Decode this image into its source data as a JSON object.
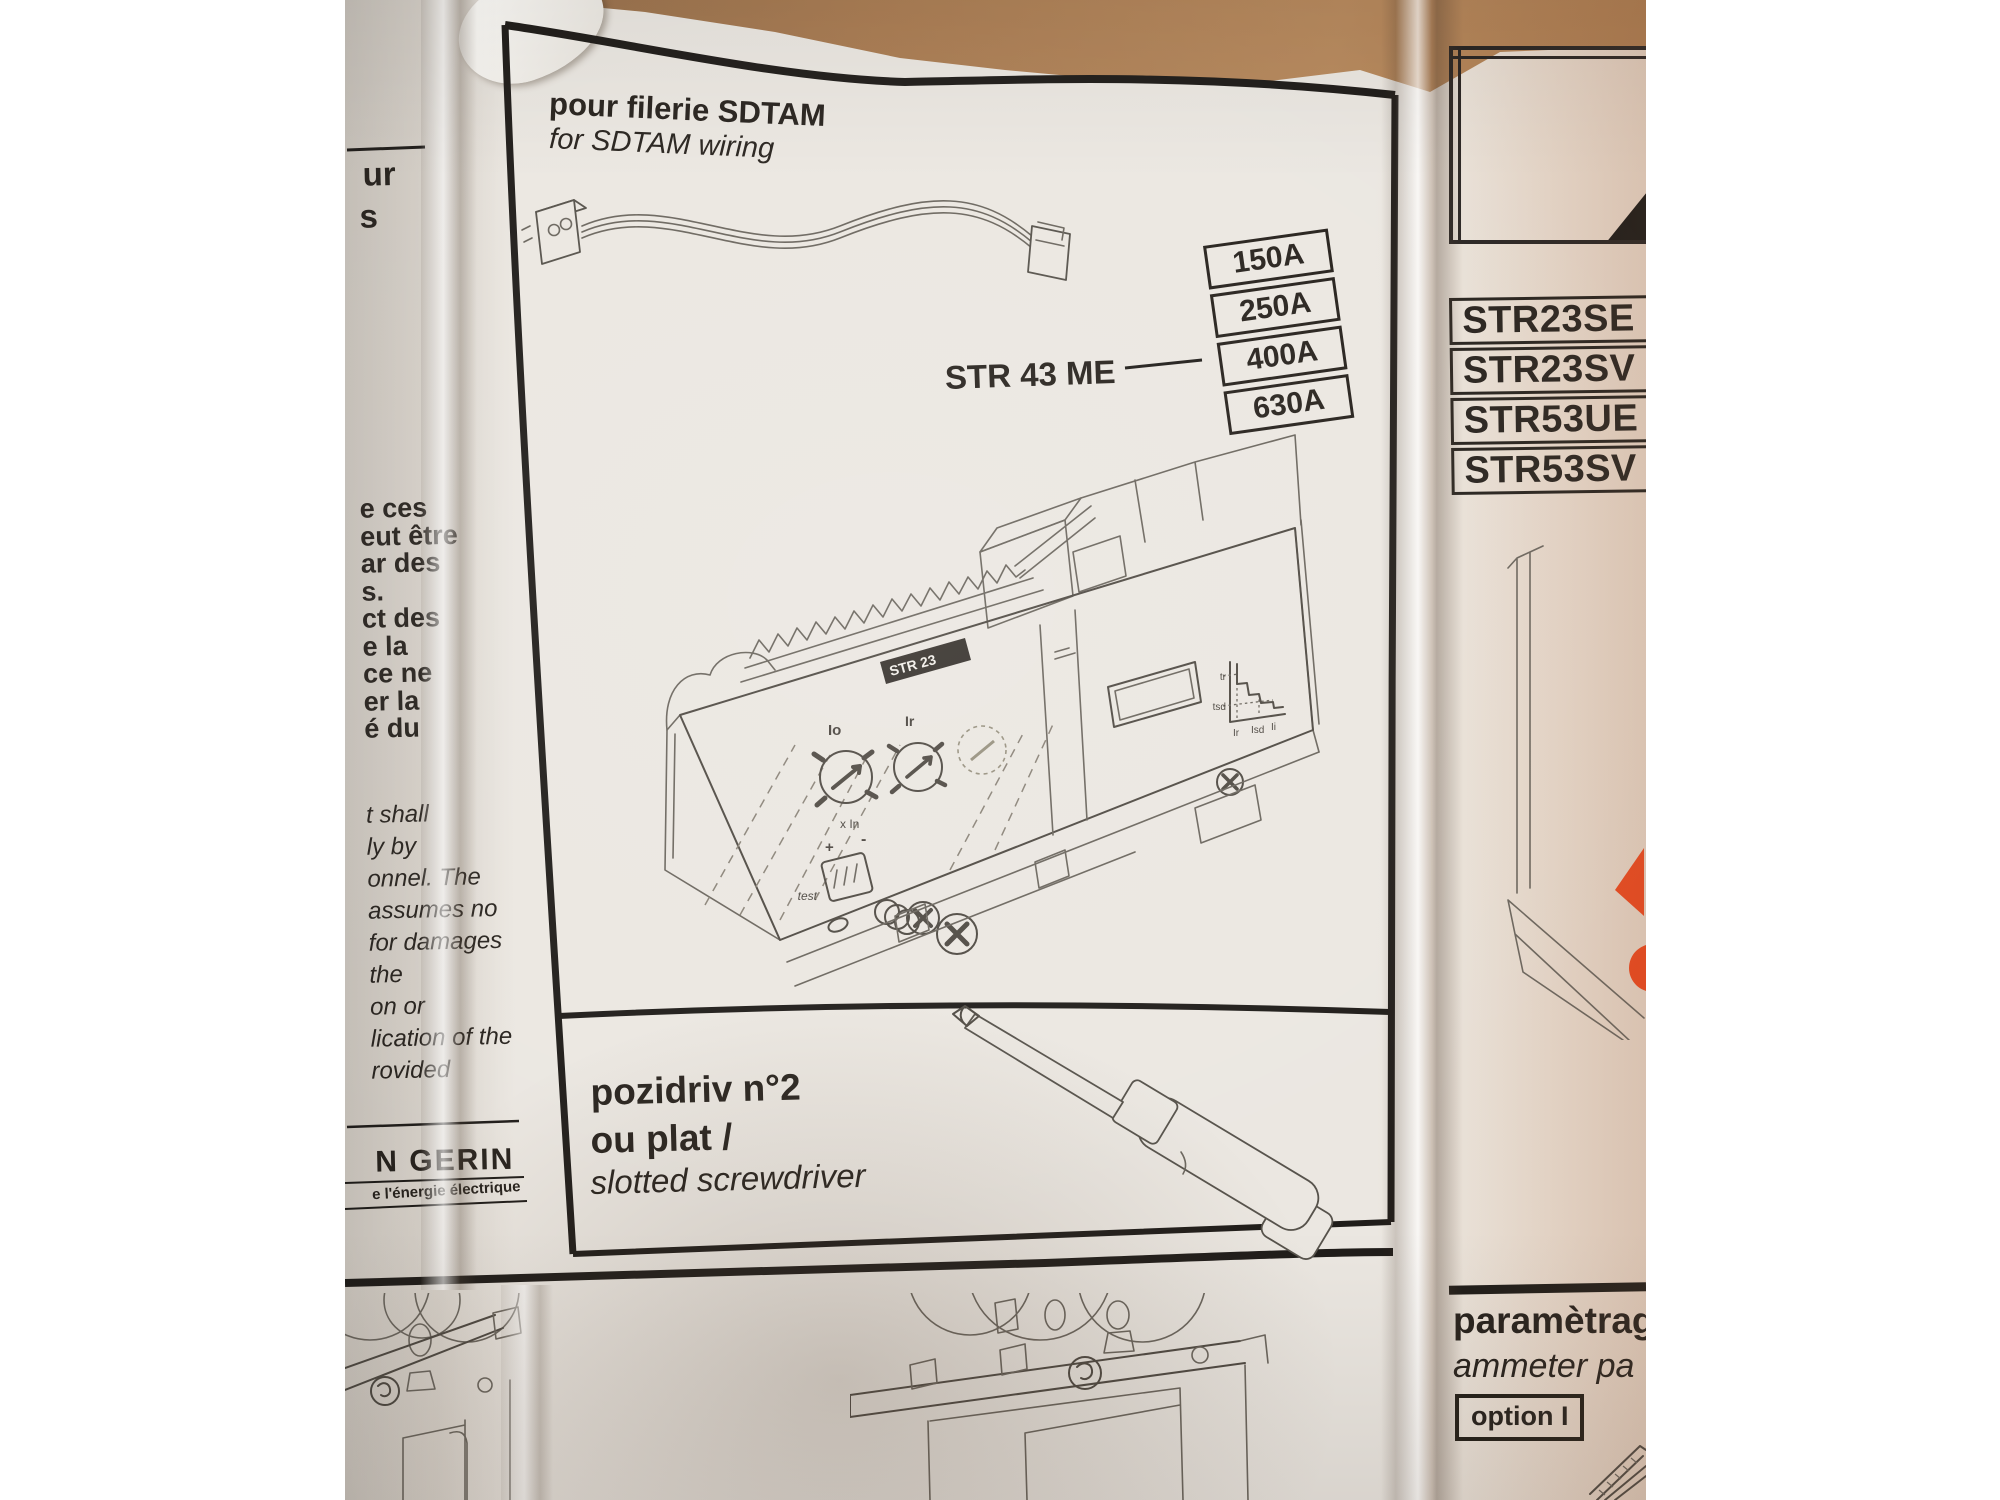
{
  "photo": {
    "left_column": {
      "top_fragment": "ur",
      "top_fragment2": "s",
      "french_lines": [
        "e ces",
        "eut être",
        "ar des",
        "s.",
        "ct des",
        "e la",
        "ce ne",
        "er la",
        "é du"
      ],
      "english_lines": [
        "t shall",
        "ly by",
        "onnel. The",
        "assumes no",
        "for damages",
        "the",
        "on or",
        "lication of the",
        "rovided"
      ],
      "brand": "N GERIN",
      "tagline": "e l'énergie électrique"
    },
    "center_panel": {
      "title_fr": "pour filerie SDTAM",
      "title_en": "for SDTAM wiring",
      "model": "STR 43 ME",
      "ratings": [
        "150A",
        "250A",
        "400A",
        "630A"
      ],
      "device": {
        "label": "STR 23",
        "dial1": "Io",
        "dial1_sub": "x In",
        "dial2": "Ir",
        "test": "test",
        "plus": "+",
        "minus": "-",
        "curve_y": [
          "tr",
          "tsd"
        ],
        "curve_x": [
          "Ir",
          "Isd",
          "Ii"
        ]
      },
      "tool_line1": "pozidriv n°2",
      "tool_line2": "ou plat /",
      "tool_line3": "slotted screwdriver"
    },
    "right_panel": {
      "models": [
        "STR23SE",
        "STR23SV",
        "STR53UE",
        "STR53SV"
      ],
      "param_fr": "paramètrag",
      "param_en": "ammeter pa",
      "option": "option I"
    }
  },
  "colors": {
    "accent": "#e8481e",
    "wood": "#a87c54",
    "ink": "#28231e",
    "paper": "#ebe7e1"
  }
}
